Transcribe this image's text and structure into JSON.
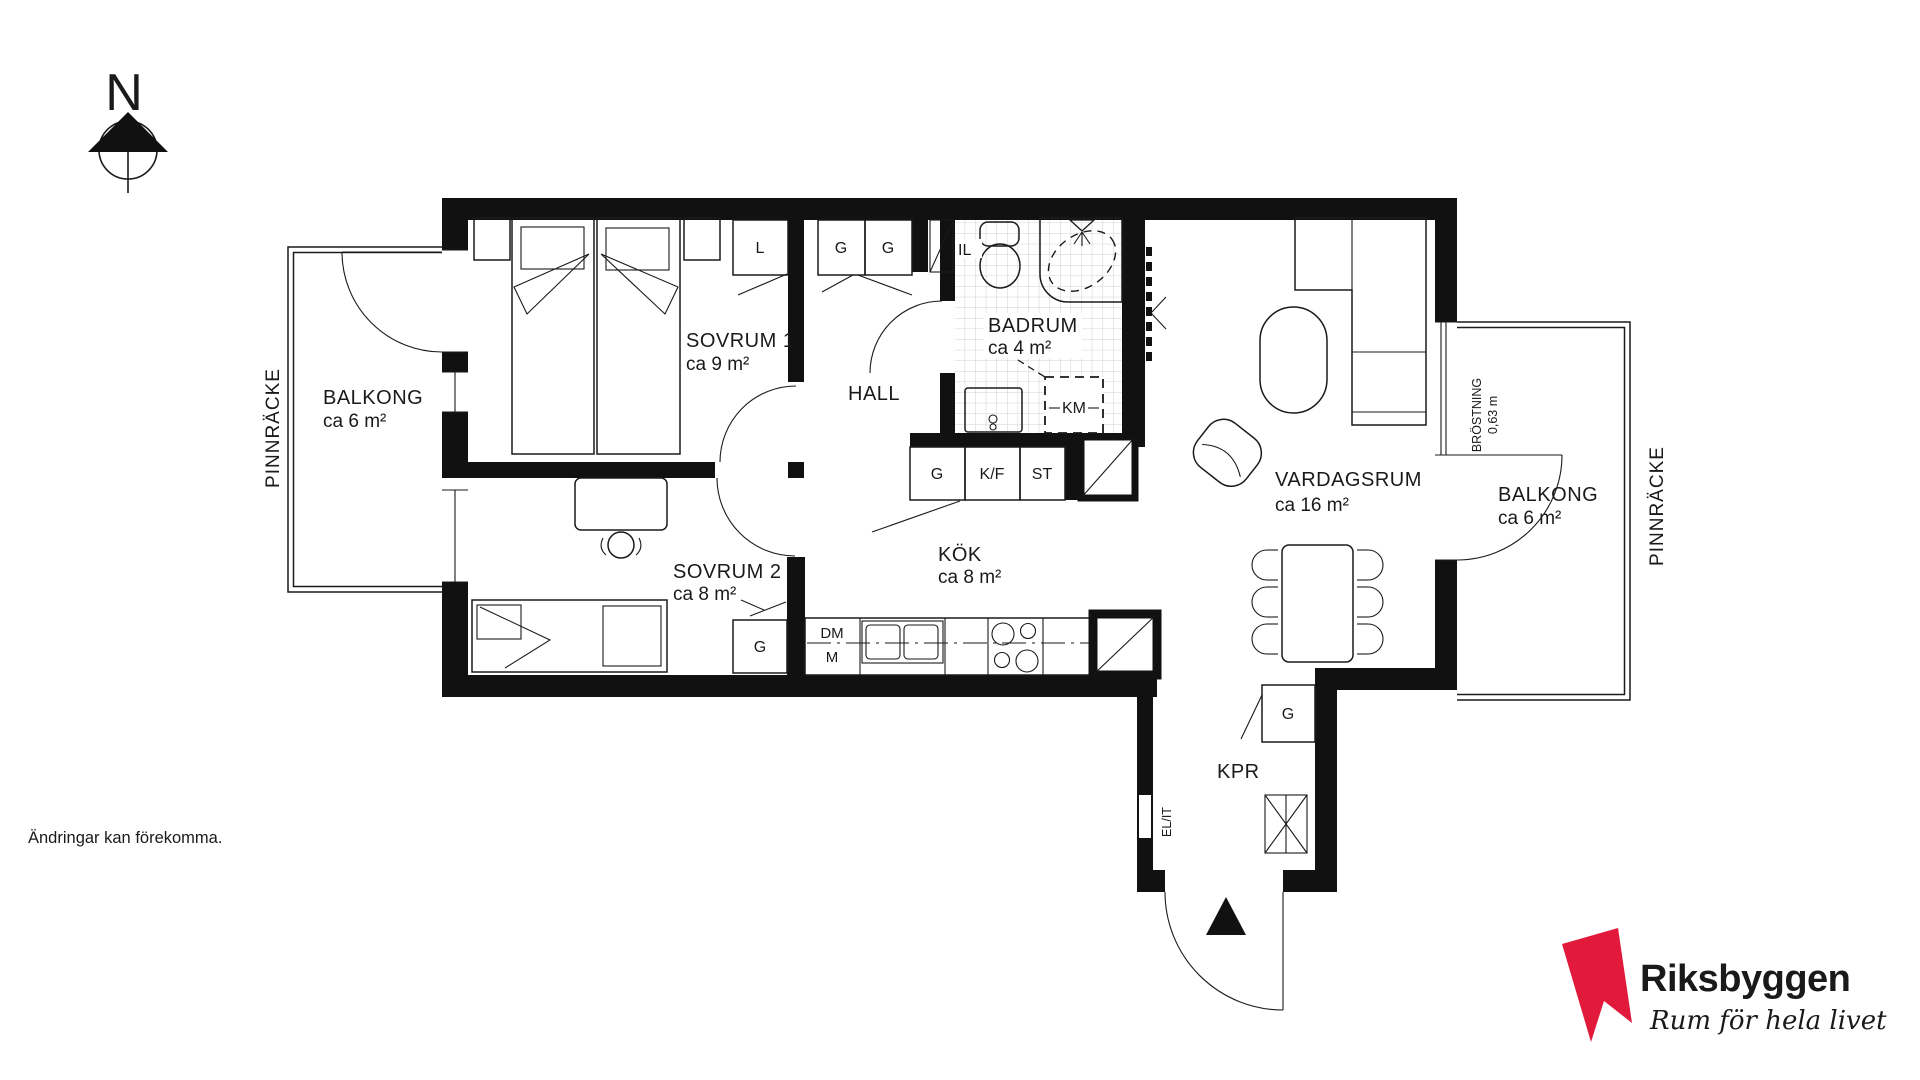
{
  "compass": {
    "label": "N"
  },
  "balcony_left": {
    "name": "BALKONG",
    "area": "ca 6 m²",
    "railing_label": "PINNRÄCKE"
  },
  "balcony_right": {
    "name": "BALKONG",
    "area": "ca 6 m²",
    "railing_label": "PINNRÄCKE",
    "parapet_label": "BRÖSTNING",
    "parapet_height": "0,63 m"
  },
  "rooms": {
    "sovrum1": {
      "name": "SOVRUM 1",
      "area": "ca 9 m²"
    },
    "sovrum2": {
      "name": "SOVRUM 2",
      "area": "ca 8 m²"
    },
    "hall": {
      "name": "HALL"
    },
    "badrum": {
      "name": "BADRUM",
      "area": "ca 4 m²"
    },
    "kok": {
      "name": "KÖK",
      "area": "ca 8 m²"
    },
    "vardagsrum": {
      "name": "VARDAGSRUM",
      "area": "ca 16 m²"
    },
    "kpr": {
      "name": "KPR"
    }
  },
  "fixtures": {
    "linen_cabinet": "L",
    "wardrobe_hall_1": "G",
    "wardrobe_hall_2": "G",
    "inspection_hatch": "IL",
    "washing_machine": "KM",
    "cabinet_kitchen": "G",
    "fridge_freezer": "K/F",
    "tall_cabinet": "ST",
    "dishwasher": "DM",
    "microwave": "M",
    "wardrobe_bedroom2": "G",
    "wardrobe_kpr": "G",
    "electrical_panel": "EL/IT"
  },
  "footer": {
    "disclaimer": "Ändringar kan förekomma."
  },
  "brand": {
    "name": "Riksbyggen",
    "tagline": "Rum för hela livet",
    "accent_color": "#e11a3c",
    "text_color": "#3b3b3d",
    "line_color": "#1a1a1a"
  }
}
